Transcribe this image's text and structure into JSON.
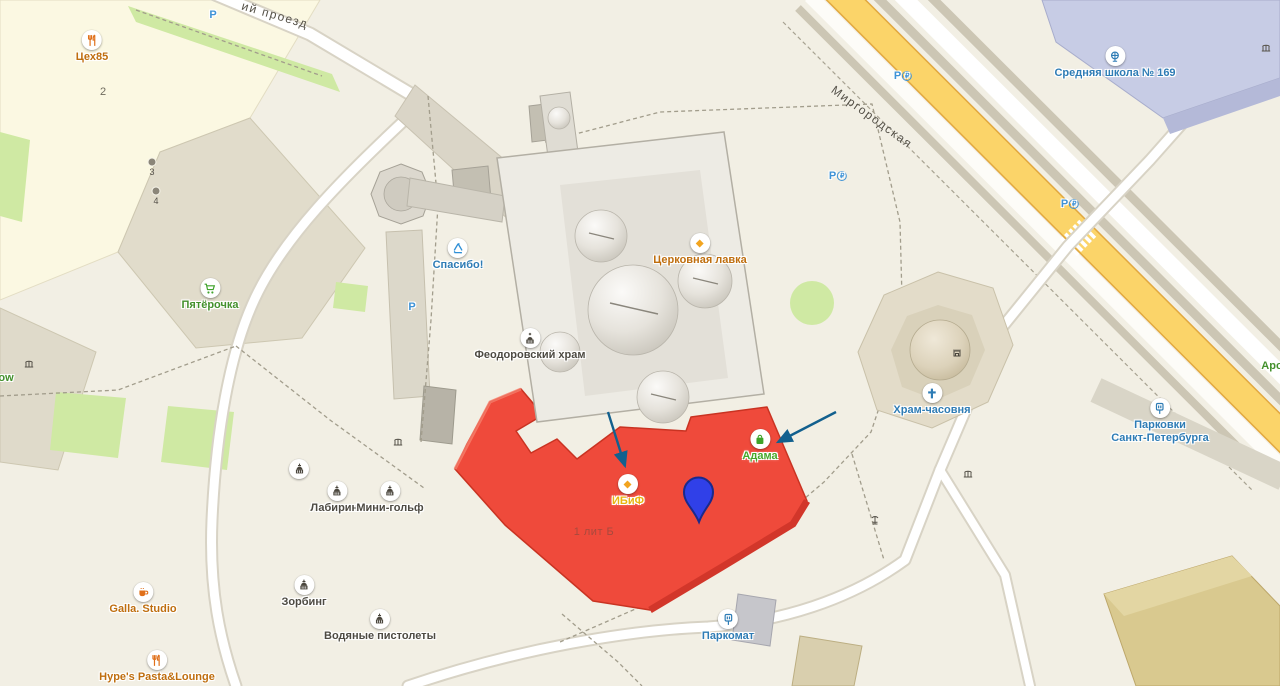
{
  "colors": {
    "background": "#f2efe4",
    "highlight_building": "#ef4a3b",
    "pin": "#3040e8",
    "arrow": "#12608e",
    "main_road_yellow": "#fbd469",
    "poi_orange": "#bf6e0e",
    "poi_green": "#43902c",
    "poi_blue": "#2e7cb5"
  },
  "streets": {
    "proezd": "ий проезд",
    "mirgorodskaya": "Миргородская"
  },
  "pois": {
    "tseh85": {
      "label": "Цех85",
      "icon": "restaurant-icon"
    },
    "pyaterochka": {
      "label": "Пятёрочка",
      "icon": "shopping-cart-icon"
    },
    "spasibo": {
      "label": "Спасибо!",
      "icon": "recycle-icon"
    },
    "lavka": {
      "label": "Церковная лавка",
      "icon": "diamond-icon"
    },
    "hram": {
      "label": "Феодоровский храм",
      "icon": "church-icon"
    },
    "ibif": {
      "label": "ИБиФ",
      "icon": "diamond-icon"
    },
    "adama": {
      "label": "Адама",
      "icon": "shopping-bag-icon"
    },
    "chasovnya": {
      "label": "Храм-часовня",
      "icon": "cross-icon"
    },
    "school": {
      "label": "Средняя школа № 169",
      "icon": "globe-icon"
    },
    "parkovki": {
      "line1": "Парковки",
      "line2": "Санкт-Петербурга",
      "icon": "parking-meter-icon"
    },
    "parkomat": {
      "label": "Паркомат",
      "icon": "parking-meter-icon"
    },
    "labirint": {
      "label": "Лабиринт",
      "icon": "attraction-icon"
    },
    "minigolf": {
      "label": "Мини-гольф",
      "icon": "attraction-icon"
    },
    "zorbing": {
      "label": "Зорбинг",
      "icon": "attraction-icon"
    },
    "vodyanye": {
      "label": "Водяные пистолеты",
      "icon": "attraction-icon"
    },
    "galla": {
      "label": "Galla. Studio",
      "icon": "cafe-icon"
    },
    "hype": {
      "label": "Hype's Pasta&Lounge",
      "icon": "restaurant-icon"
    }
  },
  "building_labels": {
    "number2": "2",
    "entrance3": "3",
    "entrance4": "4",
    "lit_b": "1 лит Б"
  },
  "partial_labels": {
    "right_edge": "Аро",
    "left_edge": "ow"
  },
  "parking": {
    "letter": "P",
    "paid_mark": "₽"
  }
}
